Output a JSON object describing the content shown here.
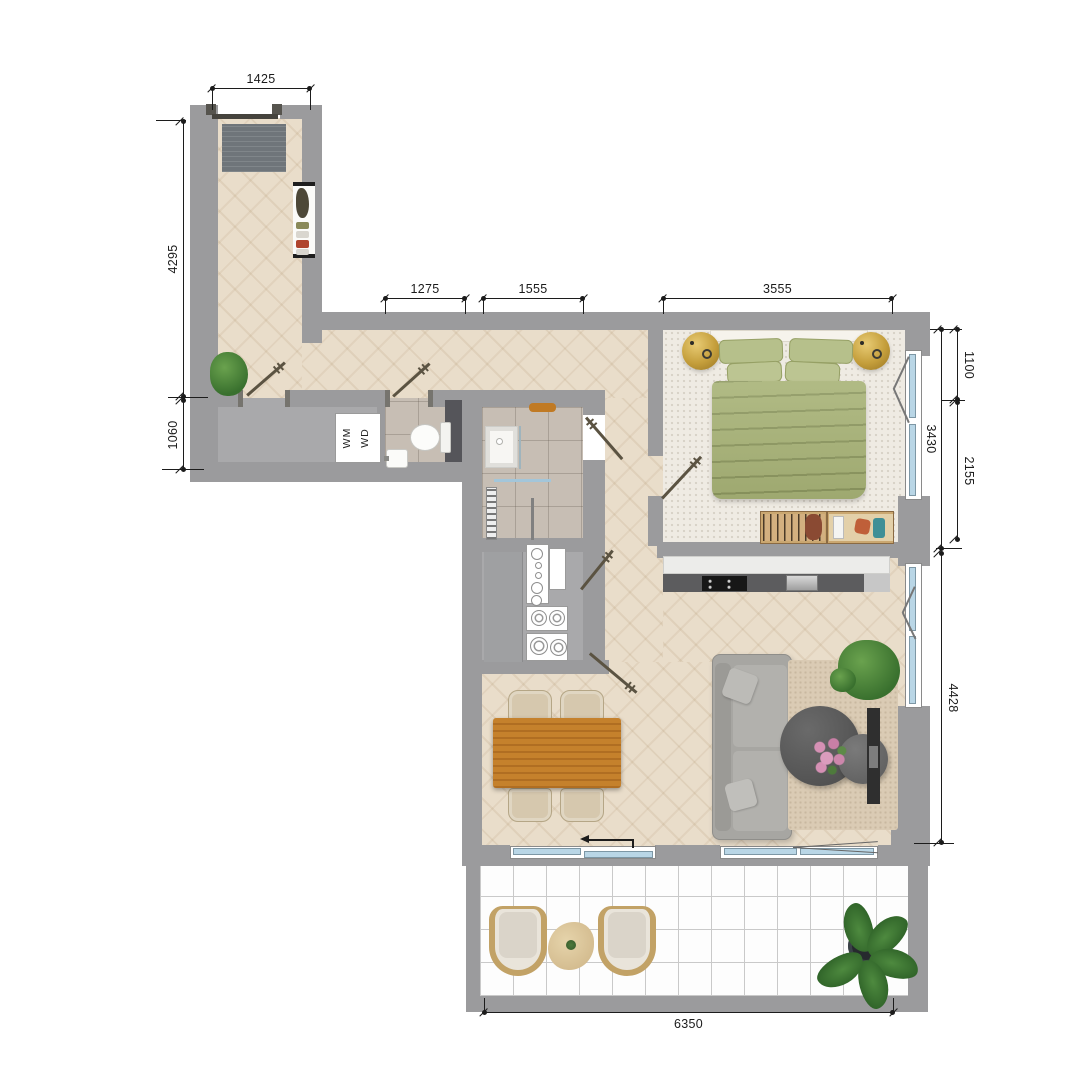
{
  "floorplan": {
    "dimensions": {
      "entry_width": "1425",
      "hall_length": "4295",
      "utility_depth": "1060",
      "hall_top_a": "1275",
      "hall_top_b": "1555",
      "bedroom_width": "3555",
      "window_offset": "1100",
      "bedroom_depth": "3430",
      "window_span": "2155",
      "living_depth": "4428",
      "balcony_width": "6350"
    },
    "labels": {
      "washing_machine": "WM",
      "dryer": "WD"
    },
    "colors": {
      "wall": "#9b9b9d",
      "wood_floor": "#e9ddca",
      "carpet": "#efebe3",
      "tile": "#c7beb4",
      "utility_floor": "#a9a9ab",
      "bed": "#a8b377",
      "brass": "#c79f3a",
      "glass": "#b9d6e6",
      "sofa": "#a7a6a2",
      "table_wood": "#c5812c",
      "dimension_line": "#1c1c1c"
    }
  }
}
